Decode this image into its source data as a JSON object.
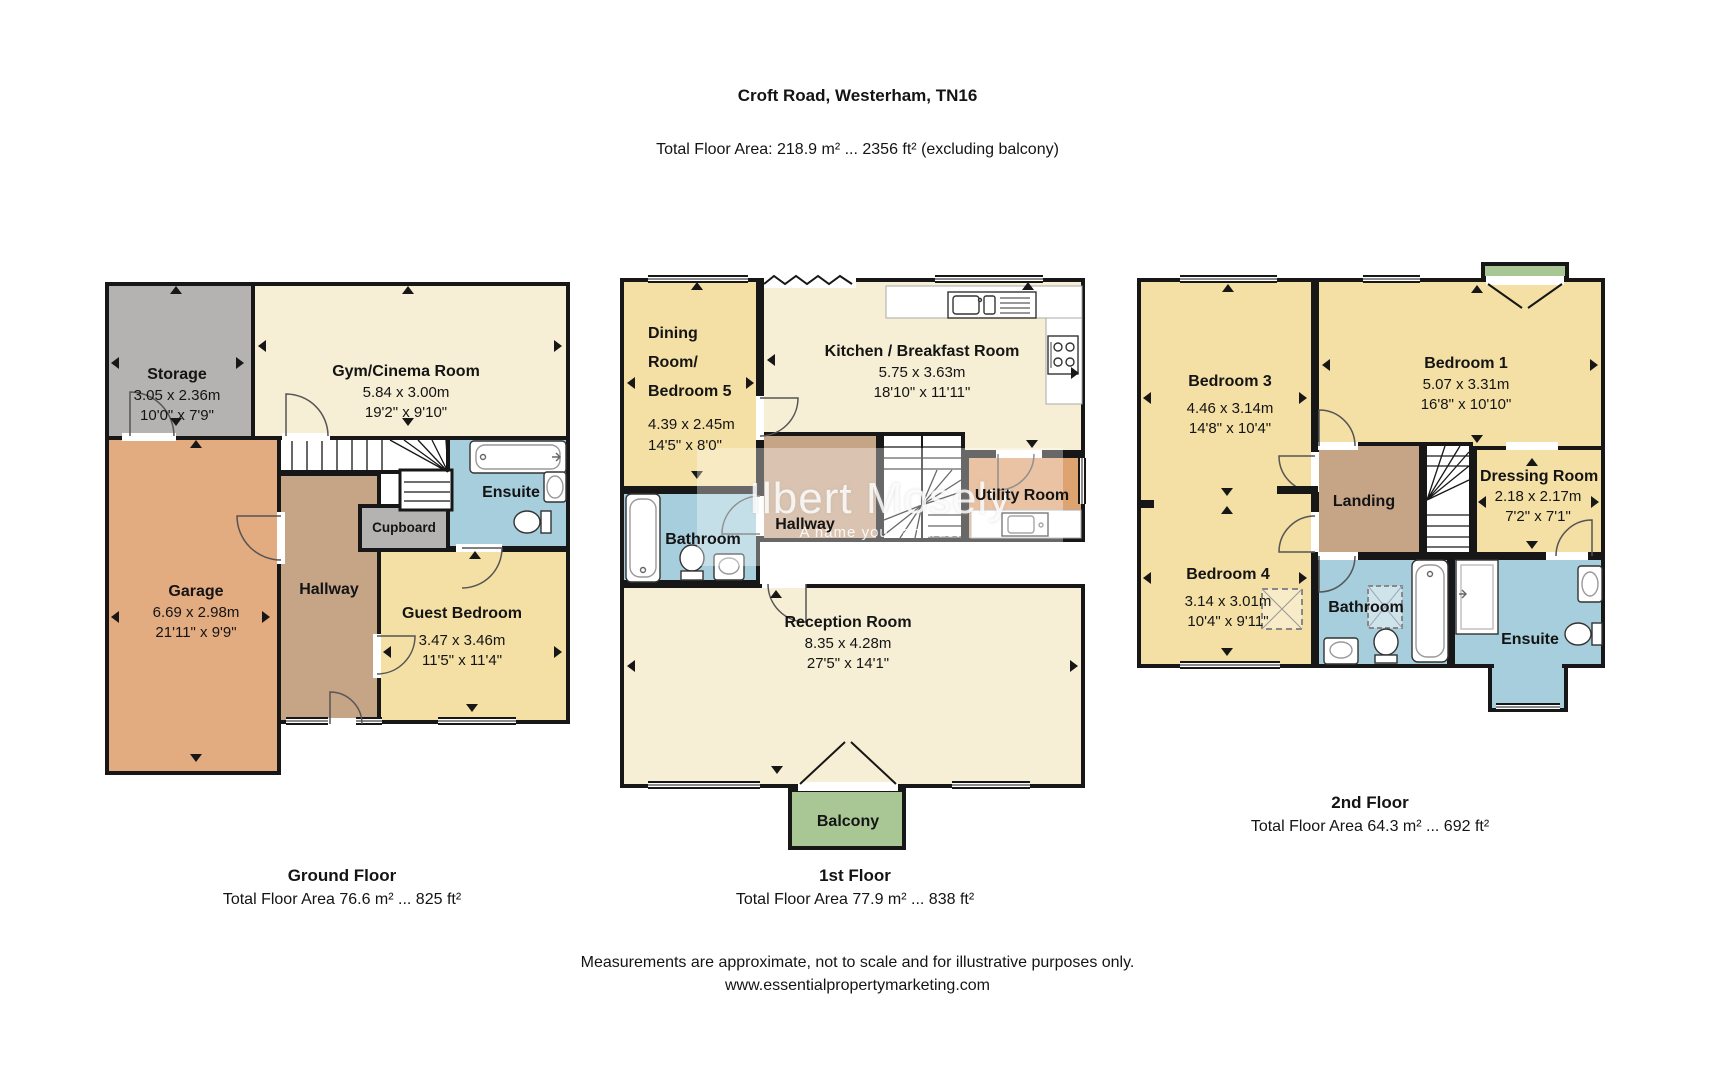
{
  "header": {
    "title": "Croft Road, Westerham, TN16",
    "subtitle": "Total Floor Area: 218.9 m² ... 2356 ft² (excluding balcony)"
  },
  "floors": [
    {
      "title": "Ground Floor",
      "area": "Total Floor Area 76.6 m² ... 825 ft²",
      "rooms": {
        "storage": {
          "name": "Storage",
          "m": "3.05 x 2.36m",
          "ft": "10'0\" x 7'9\""
        },
        "gym": {
          "name": "Gym/Cinema Room",
          "m": "5.84 x 3.00m",
          "ft": "19'2\" x 9'10\""
        },
        "garage": {
          "name": "Garage",
          "m": "6.69 x 2.98m",
          "ft": "21'11\" x 9'9\""
        },
        "hallway": {
          "name": "Hallway"
        },
        "cupboard": {
          "name": "Cupboard"
        },
        "ensuite": {
          "name": "Ensuite"
        },
        "guest": {
          "name": "Guest Bedroom",
          "m": "3.47 x 3.46m",
          "ft": "11'5\" x 11'4\""
        }
      }
    },
    {
      "title": "1st Floor",
      "area": "Total Floor Area 77.9 m² ... 838 ft²",
      "rooms": {
        "dining": {
          "name": "Dining Room/",
          "name2": "Bedroom 5",
          "m": "4.39 x 2.45m",
          "ft": "14'5\" x 8'0\""
        },
        "kitchen": {
          "name": "Kitchen / Breakfast Room",
          "m": "5.75 x 3.63m",
          "ft": "18'10\" x 11'11\""
        },
        "hallway": {
          "name": "Hallway"
        },
        "utility": {
          "name": "Utility Room"
        },
        "bathroom": {
          "name": "Bathroom"
        },
        "reception": {
          "name": "Reception Room",
          "m": "8.35 x 4.28m",
          "ft": "27'5\" x 14'1\""
        },
        "balcony": {
          "name": "Balcony"
        }
      }
    },
    {
      "title": "2nd Floor",
      "area": "Total Floor Area 64.3 m² ... 692 ft²",
      "rooms": {
        "bed3": {
          "name": "Bedroom 3",
          "m": "4.46 x 3.14m",
          "ft": "14'8\" x 10'4\""
        },
        "bed1": {
          "name": "Bedroom 1",
          "m": "5.07 x 3.31m",
          "ft": "16'8\" x 10'10\""
        },
        "landing": {
          "name": "Landing"
        },
        "dressing": {
          "name": "Dressing Room",
          "m": "2.18 x 2.17m",
          "ft": "7'2\" x 7'1\""
        },
        "bed4": {
          "name": "Bedroom 4",
          "m": "3.14 x 3.01m",
          "ft": "10'4\" x 9'11\""
        },
        "bathroom": {
          "name": "Bathroom"
        },
        "ensuite": {
          "name": "Ensuite"
        }
      }
    }
  ],
  "watermark": {
    "line1": "Ilbert Mosely",
    "line2": "A name you can trust"
  },
  "disclaimer": {
    "line1": "Measurements are approximate, not to scale and for illustrative purposes only.",
    "line2": "www.essentialpropertymarketing.com"
  },
  "colors": {
    "cream": "#f6eed5",
    "yellow": "#f4e0a4",
    "garage_tan": "#e3ab80",
    "hall_brown": "#c6a587",
    "storage_gray": "#b4b3b1",
    "bath_blue": "#a7cedd",
    "balcony_green": "#a9c795",
    "utility_orange": "#dda472",
    "wall": "#171717"
  }
}
